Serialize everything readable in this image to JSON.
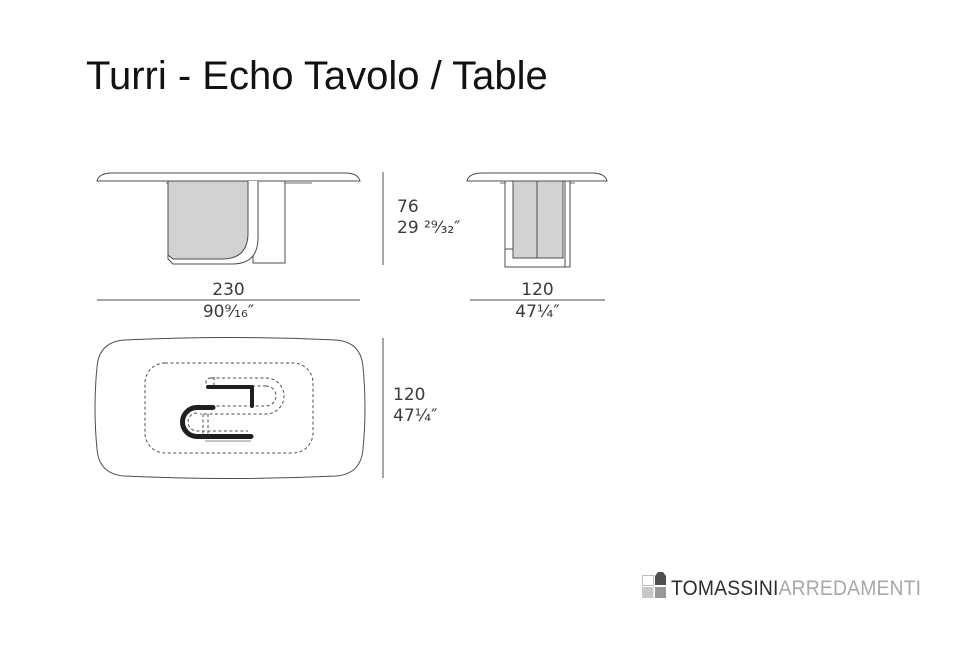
{
  "title": "Turri - Echo Tavolo / Table",
  "views": {
    "front": {
      "height": {
        "cm": "76",
        "in": "29 ²⁹⁄₃₂″"
      },
      "width": {
        "cm": "230",
        "in": "90⁹⁄₁₆″"
      }
    },
    "side": {
      "width": {
        "cm": "120",
        "in": "47¼″"
      }
    },
    "plan": {
      "depth": {
        "cm": "120",
        "in": "47¼″"
      }
    }
  },
  "logo": {
    "brand": "TOMASSINI",
    "suffix": "ARREDAMENTI"
  },
  "colors": {
    "line": "#4d4d4d",
    "panel_fill": "#d2d2d2",
    "dim_text": "#3b3b3b",
    "logo_dark": "#2e2e2e",
    "logo_light": "#a8a8a8",
    "logo_square_light": "#c8c8c8",
    "logo_square_mid": "#989898",
    "logo_house": "#4f4f4f"
  }
}
